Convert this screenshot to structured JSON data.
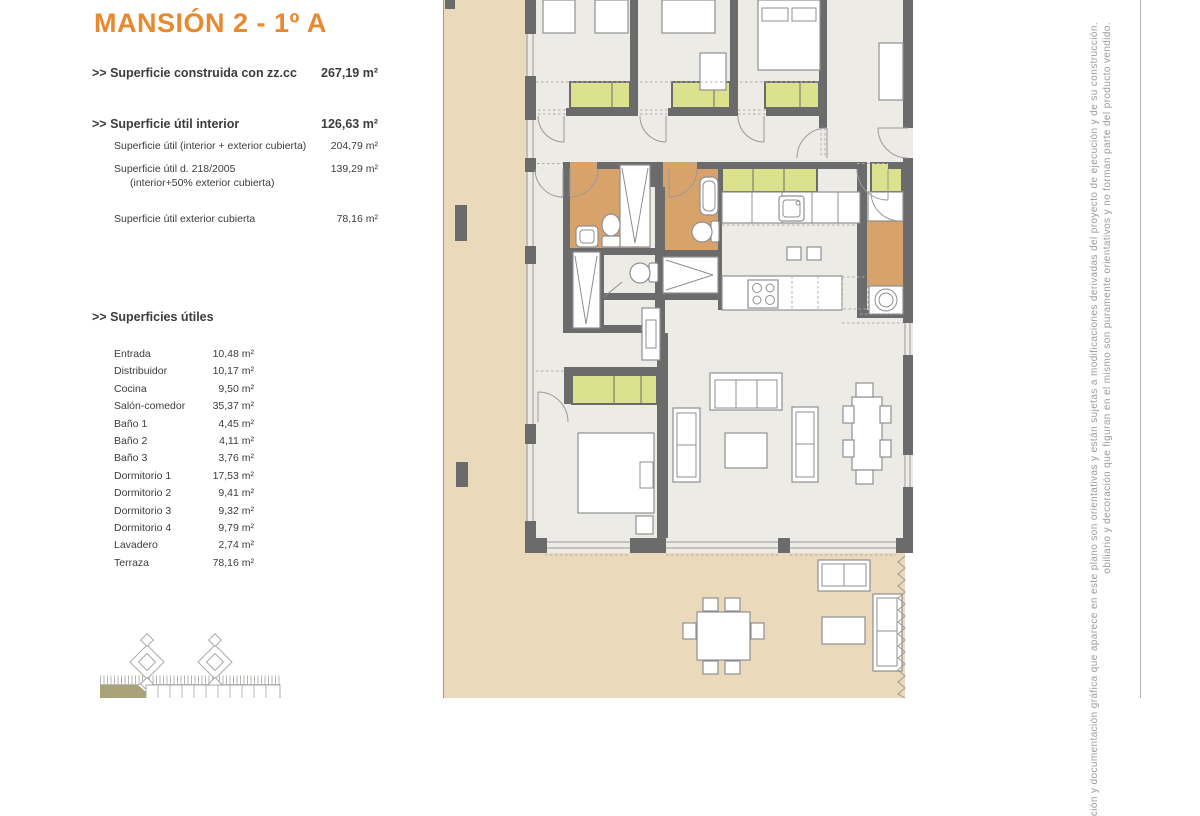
{
  "header": {
    "title": "MANSIÓN 2 - 1º A"
  },
  "summary": {
    "rows": [
      {
        "label": ">> Superficie construida con zz.cc",
        "value": "267,19 m²"
      },
      {
        "label": ">> Superficie útil interior",
        "value": "126,63 m²"
      },
      {
        "label": "Superficie útil (interior + exterior cubierta)",
        "value": "204,79 m²"
      },
      {
        "label": "Superficie útil  d. 218/2005",
        "sublabel": "(interior+50% exterior cubierta)",
        "value": "139,29 m²"
      },
      {
        "label": "Superficie útil exterior cubierta",
        "value": "78,16 m²"
      }
    ]
  },
  "rooms": {
    "heading": ">> Superficies útiles",
    "items": [
      {
        "name": "Entrada",
        "area": "10,48 m²"
      },
      {
        "name": "Distribuidor",
        "area": "10,17 m²"
      },
      {
        "name": "Cocina",
        "area": "9,50 m²"
      },
      {
        "name": "Salón-comedor",
        "area": "35,37 m²"
      },
      {
        "name": "Baño 1",
        "area": "4,45 m²"
      },
      {
        "name": "Baño 2",
        "area": "4,11 m²"
      },
      {
        "name": "Baño 3",
        "area": "3,76 m²"
      },
      {
        "name": "Dormitorio 1",
        "area": "17,53 m²"
      },
      {
        "name": "Dormitorio 2",
        "area": "9,41 m²"
      },
      {
        "name": "Dormitorio 3",
        "area": "9,32 m²"
      },
      {
        "name": "Dormitorio 4",
        "area": "9,79 m²"
      },
      {
        "name": "Lavadero",
        "area": "2,74 m²"
      },
      {
        "name": "Terraza",
        "area": "78,16 m²"
      }
    ]
  },
  "disclaimer": {
    "line1": "ción y documentación gráfica que aparece en este plano son orientativas y están sujetas a modificaciones derivadas del proyecto de ejecución y de su construcción.",
    "line2": "obiliario y decoración que figuran en el mismo son puramente orientativos y no forman parte del producto vendido."
  },
  "colors": {
    "accent": "#E8892F",
    "terrace": "#EBD9BC",
    "floor": "#ECEBE6",
    "wall": "#6B6B6B",
    "green": "#DCE18D",
    "bath": "#D8A26B",
    "stroke": "#8F8F8F",
    "text": "#3C3C3C",
    "muted": "#9B9B9B",
    "olive": "#A9A178"
  }
}
